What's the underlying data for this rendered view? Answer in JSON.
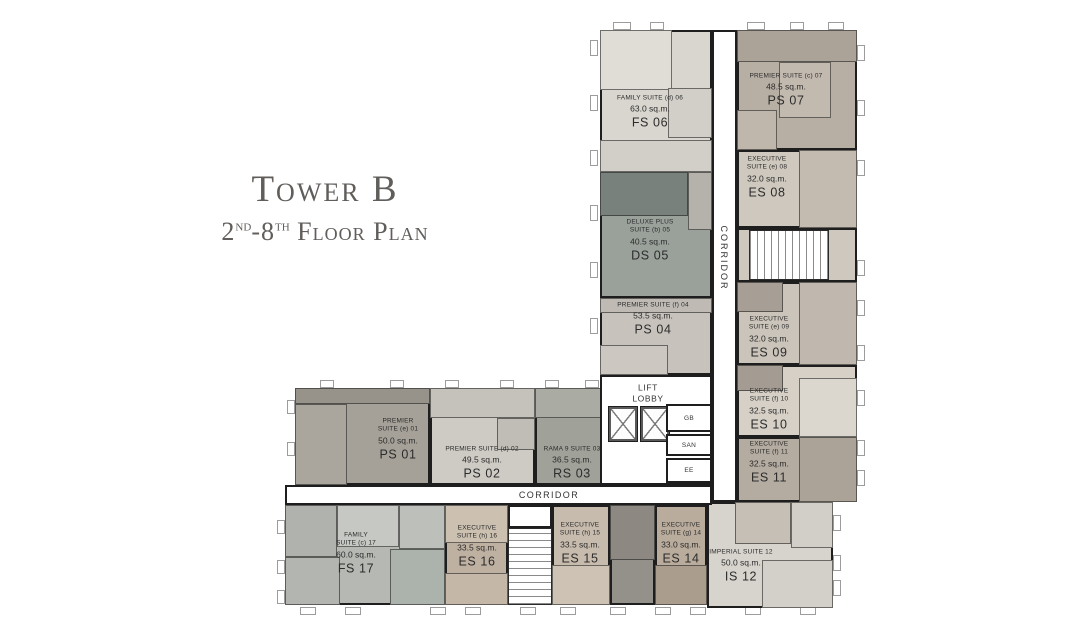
{
  "title": {
    "main": "Tower B",
    "sub": {
      "n1": "2",
      "s1": "nd",
      "n2": "-8",
      "s2": "th",
      "text": " Floor Plan"
    }
  },
  "plan": {
    "wall_color": "#1e1e1e",
    "background": "#ffffff",
    "labels": {
      "lift_lobby": "LIFT\nLOBBY",
      "corridor_vertical": "CORRIDOR",
      "corridor_horizontal": "CORRIDOR"
    },
    "units": [
      {
        "code": "PS 01",
        "name_lines": [
          "PREMIER",
          "SUITE (e) 01"
        ],
        "area": "50.0 sq.m.",
        "fill": "#a5a198",
        "rect": [
          295,
          388,
          135,
          97
        ],
        "label": [
          398,
          440
        ],
        "cells": [
          [
            295,
            388,
            135,
            16,
            "#97938b"
          ],
          [
            295,
            404,
            52,
            81,
            "#aaa69d"
          ]
        ]
      },
      {
        "code": "PS 02",
        "name_lines": [
          "PREMIER SUITE (d) 02"
        ],
        "area": "49.5 sq.m.",
        "fill": "#cecbc4",
        "rect": [
          430,
          388,
          105,
          97
        ],
        "label": [
          482,
          464
        ],
        "cells": [
          [
            430,
            388,
            105,
            30,
            "#c5c2bb"
          ],
          [
            497,
            418,
            38,
            32,
            "#c0bdb6"
          ]
        ]
      },
      {
        "code": "RS 03",
        "name_lines": [
          "RAMA 9  SUITE  03"
        ],
        "area": "36.5 sq.m.",
        "fill": "#a0a199",
        "rect": [
          535,
          388,
          80,
          97
        ],
        "label": [
          572,
          464
        ],
        "cells": [
          [
            535,
            388,
            80,
            30,
            "#aaaba3"
          ]
        ]
      },
      {
        "code": "PS 04",
        "name_lines": [
          "PREMIER SUITE (f) 04"
        ],
        "area": "53.5 sq.m.",
        "fill": "#c7c3bc",
        "rect": [
          600,
          298,
          112,
          77
        ],
        "label": [
          653,
          320
        ],
        "cells": [
          [
            600,
            298,
            112,
            15,
            "#bfbbb4"
          ],
          [
            600,
            345,
            68,
            30,
            "#ccc8c1"
          ]
        ]
      },
      {
        "code": "DS 05",
        "name_lines": [
          "DELUXE PLUS",
          "SUITE (b) 05"
        ],
        "area": "40.5 sq.m.",
        "fill": "#9aa19b",
        "rect": [
          600,
          172,
          112,
          126
        ],
        "label": [
          650,
          241
        ],
        "cells": [
          [
            600,
            172,
            88,
            44,
            "#78817b"
          ],
          [
            688,
            172,
            24,
            58,
            "#b5b2ab"
          ]
        ]
      },
      {
        "code": "FS 06",
        "name_lines": [
          "FAMILY SUITE (d) 06"
        ],
        "area": "63.0 sq.m.",
        "fill": "#d9d6cf",
        "rect": [
          600,
          30,
          112,
          142
        ],
        "label": [
          650,
          113
        ],
        "cells": [
          [
            600,
            30,
            72,
            60,
            "#e0ddd6"
          ],
          [
            668,
            88,
            44,
            50,
            "#d2cfc8"
          ],
          [
            600,
            140,
            112,
            32,
            "#d2cfc8"
          ]
        ]
      },
      {
        "code": "PS 07",
        "name_lines": [
          "PREMIER SUITE (c) 07"
        ],
        "area": "48.5 sq.m.",
        "fill": "#b7aea4",
        "rect": [
          737,
          30,
          120,
          120
        ],
        "label": [
          786,
          91
        ],
        "cells": [
          [
            737,
            30,
            120,
            32,
            "#aba298"
          ],
          [
            779,
            62,
            52,
            56,
            "#c2b9af"
          ],
          [
            737,
            110,
            40,
            40,
            "#bfb6ac"
          ]
        ]
      },
      {
        "code": "ES 08",
        "name_lines": [
          "EXECUTIVE",
          "SUITE (e) 08"
        ],
        "area": "32.0 sq.m.",
        "fill": "#cfc8be",
        "rect": [
          737,
          150,
          120,
          78
        ],
        "label": [
          767,
          178
        ],
        "cells": [
          [
            799,
            150,
            58,
            78,
            "#c3bbb0"
          ]
        ]
      },
      {
        "code": "ES 09",
        "name_lines": [
          "EXECUTIVE",
          "SUITE (e) 09"
        ],
        "area": "32.0 sq.m.",
        "fill": "#cbc4ba",
        "rect": [
          737,
          282,
          120,
          83
        ],
        "label": [
          769,
          338
        ],
        "cells": [
          [
            737,
            282,
            46,
            30,
            "#a79f95"
          ],
          [
            799,
            282,
            58,
            83,
            "#c0b8ae"
          ]
        ]
      },
      {
        "code": "ES 10",
        "name_lines": [
          "EXECUTIVE",
          "SUITE (f) 10"
        ],
        "area": "32.5 sq.m.",
        "fill": "#d6d0c7",
        "rect": [
          737,
          365,
          120,
          72
        ],
        "label": [
          769,
          410
        ],
        "cells": [
          [
            737,
            365,
            46,
            26,
            "#a49c92"
          ],
          [
            799,
            378,
            58,
            59,
            "#dcd7ce"
          ]
        ]
      },
      {
        "code": "ES 11",
        "name_lines": [
          "EXECUTIVE",
          "SUITE (f) 11"
        ],
        "area": "32.5 sq.m.",
        "fill": "#b4aba1",
        "rect": [
          737,
          437,
          120,
          65
        ],
        "label": [
          769,
          463
        ],
        "cells": [
          [
            799,
            437,
            58,
            65,
            "#aca398"
          ]
        ]
      },
      {
        "code": "IS 12",
        "name_lines": [
          "IMPERIAL SUITE 12"
        ],
        "area": "50.0 sq.m.",
        "fill": "#d7d4cd",
        "rect": [
          707,
          502,
          126,
          106
        ],
        "label": [
          741,
          567
        ],
        "cells": [
          [
            735,
            502,
            56,
            42,
            "#c6bfb5"
          ],
          [
            791,
            502,
            42,
            46,
            "#d2cfc8"
          ],
          [
            762,
            560,
            71,
            48,
            "#d3d0c9"
          ]
        ]
      },
      {
        "code": "ES 14",
        "name_lines": [
          "EXECUTIVE",
          "SUITE (g) 14"
        ],
        "area": "33.0 sq.m.",
        "fill": "#b9ac9c",
        "rect": [
          655,
          505,
          52,
          100
        ],
        "label": [
          681,
          544
        ],
        "cells": [
          [
            655,
            565,
            52,
            40,
            "#aa9d8d"
          ]
        ]
      },
      {
        "code": "ES 15",
        "name_lines": [
          "EXECUTIVE",
          "SUITE (h) 15"
        ],
        "area": "33.5 sq.m.",
        "fill": "#c7bbad",
        "rect": [
          552,
          505,
          58,
          100
        ],
        "label": [
          580,
          544
        ],
        "cells": [
          [
            552,
            565,
            58,
            40,
            "#cdc2b4"
          ]
        ]
      },
      {
        "code": "ES 16",
        "name_lines": [
          "EXECUTIVE",
          "SUITE (h) 16"
        ],
        "area": "33.5 sq.m.",
        "fill": "#bfb1a1",
        "rect": [
          445,
          505,
          63,
          100
        ],
        "label": [
          477,
          547
        ],
        "cells": [
          [
            445,
            505,
            63,
            38,
            "#ccc0b0"
          ],
          [
            445,
            573,
            63,
            32,
            "#c5b7a7"
          ]
        ]
      },
      {
        "code": "FS 17",
        "name_lines": [
          "FAMILY",
          "SUITE (c) 17"
        ],
        "area": "60.0 sq.m.",
        "fill": "#b5b8b3",
        "rect": [
          285,
          505,
          160,
          100
        ],
        "label": [
          356,
          554
        ],
        "cells": [
          [
            285,
            505,
            52,
            52,
            "#afb2ad"
          ],
          [
            337,
            505,
            62,
            42,
            "#c5c8c3"
          ],
          [
            399,
            505,
            46,
            44,
            "#bcbfba"
          ],
          [
            390,
            549,
            55,
            56,
            "#acb2ac"
          ],
          [
            285,
            557,
            55,
            48,
            "#b2b5b0"
          ]
        ]
      }
    ],
    "cores": [
      {
        "id": "stair-block-upper",
        "rect": [
          737,
          228,
          120,
          54
        ],
        "fill": "#cfc8be"
      },
      {
        "id": "bath-core-lower",
        "rect": [
          610,
          505,
          45,
          100
        ],
        "fill": "#94908a",
        "cells": [
          [
            610,
            505,
            45,
            55,
            "#8d8881"
          ]
        ]
      },
      {
        "id": "bath-room-lobby",
        "rect": [
          610,
          447,
          42,
          38
        ],
        "fill": "#8d948e"
      }
    ],
    "open_areas": [
      {
        "id": "lift-lobby",
        "rect": [
          600,
          375,
          112,
          110
        ]
      },
      {
        "id": "corridor-vertical",
        "rect": [
          712,
          30,
          25,
          472
        ]
      },
      {
        "id": "corridor-horizontal",
        "rect": [
          285,
          485,
          427,
          20
        ]
      },
      {
        "id": "stair-landing-lower",
        "rect": [
          508,
          505,
          44,
          23
        ]
      }
    ],
    "stairs": [
      {
        "id": "stair-upper",
        "rect": [
          749,
          230,
          80,
          50
        ],
        "dir": "v"
      },
      {
        "id": "stair-lower",
        "rect": [
          508,
          528,
          44,
          77
        ],
        "dir": "h"
      }
    ],
    "lifts": [
      {
        "rect": [
          609,
          407,
          28,
          34
        ]
      },
      {
        "rect": [
          641,
          407,
          28,
          34
        ]
      }
    ],
    "service_rooms": [
      {
        "label": "GB",
        "rect": [
          666,
          404,
          46,
          28
        ]
      },
      {
        "label": "SAN",
        "rect": [
          666,
          434,
          46,
          22
        ]
      },
      {
        "label": "EE",
        "rect": [
          666,
          458,
          46,
          25
        ]
      }
    ],
    "label_points": {
      "lift_lobby": [
        648,
        394
      ],
      "corridor_vertical": [
        724,
        258
      ],
      "corridor_horizontal": [
        549,
        495
      ]
    },
    "ticks": [
      [
        613,
        22,
        18,
        8
      ],
      [
        650,
        22,
        14,
        8
      ],
      [
        747,
        22,
        18,
        8
      ],
      [
        790,
        22,
        14,
        8
      ],
      [
        828,
        22,
        16,
        8
      ],
      [
        590,
        40,
        8,
        16
      ],
      [
        590,
        95,
        8,
        16
      ],
      [
        590,
        150,
        8,
        16
      ],
      [
        590,
        205,
        8,
        16
      ],
      [
        590,
        262,
        8,
        16
      ],
      [
        590,
        318,
        8,
        16
      ],
      [
        857,
        45,
        8,
        16
      ],
      [
        857,
        100,
        8,
        16
      ],
      [
        857,
        160,
        8,
        16
      ],
      [
        857,
        260,
        8,
        16
      ],
      [
        857,
        300,
        8,
        16
      ],
      [
        857,
        345,
        8,
        16
      ],
      [
        857,
        390,
        8,
        16
      ],
      [
        857,
        440,
        8,
        16
      ],
      [
        857,
        470,
        8,
        16
      ],
      [
        833,
        515,
        8,
        16
      ],
      [
        833,
        555,
        8,
        16
      ],
      [
        833,
        580,
        8,
        16
      ],
      [
        300,
        607,
        16,
        8
      ],
      [
        345,
        607,
        16,
        8
      ],
      [
        430,
        607,
        16,
        8
      ],
      [
        465,
        607,
        16,
        8
      ],
      [
        520,
        607,
        16,
        8
      ],
      [
        560,
        607,
        16,
        8
      ],
      [
        610,
        607,
        16,
        8
      ],
      [
        655,
        607,
        16,
        8
      ],
      [
        690,
        607,
        16,
        8
      ],
      [
        745,
        607,
        16,
        8
      ],
      [
        800,
        607,
        16,
        8
      ],
      [
        277,
        520,
        8,
        14
      ],
      [
        277,
        560,
        8,
        14
      ],
      [
        277,
        590,
        8,
        14
      ],
      [
        287,
        400,
        8,
        14
      ],
      [
        287,
        442,
        8,
        14
      ],
      [
        320,
        380,
        14,
        8
      ],
      [
        390,
        380,
        14,
        8
      ],
      [
        445,
        380,
        14,
        8
      ],
      [
        500,
        380,
        14,
        8
      ],
      [
        545,
        380,
        14,
        8
      ],
      [
        585,
        380,
        14,
        8
      ]
    ]
  }
}
